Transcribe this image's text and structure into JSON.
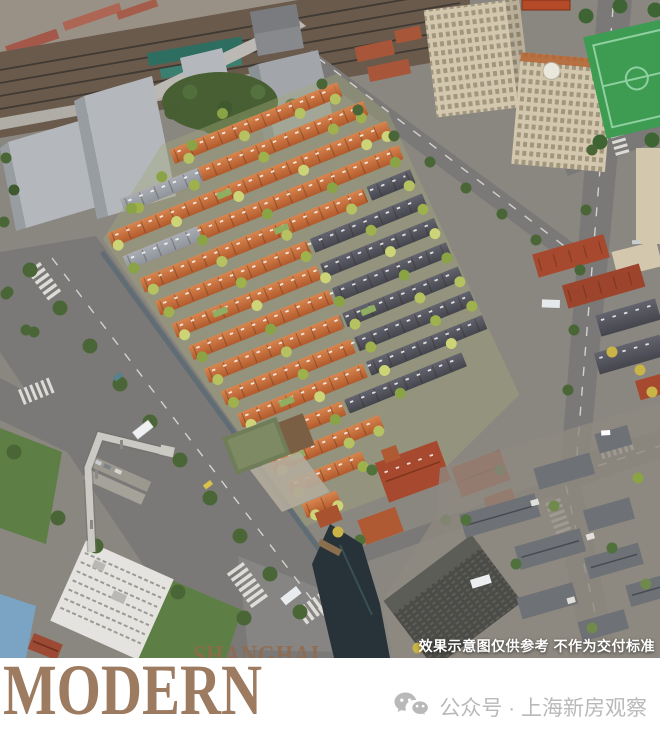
{
  "aerial": {
    "watermark": "SHANGHAI",
    "disclaimer": "效果示意图仅供参考 不作为交付标准"
  },
  "footer": {
    "brand": "MODERN",
    "account_label": "公众号 · 上海新房观察",
    "account_icon": "wechat-icon"
  },
  "palette": {
    "brand_brown": "#9c7b60",
    "watermark_brown": "#8f6a4c",
    "account_gray": "#b9b9b9",
    "disclaimer_white": "#ffffff",
    "ground": "#8a8680",
    "road": "#7b7977",
    "railway_brown": "#6a5a4c",
    "massing_gray": "#b4b8bc",
    "cream_tower": "#d3c7ae",
    "court_green": "#3d9b52",
    "terracotta_light": "#d8854e",
    "terracotta_dark": "#b15a2d",
    "slate_light": "#63646e",
    "slate_dark": "#44454d",
    "brick_red": "#a7492e",
    "heritage_roof_gray": "#6e7176",
    "water": "#273339",
    "lawn_green": "#5d7f45",
    "tree_dark": "#4a6636",
    "tree_light": "#b6c262"
  }
}
